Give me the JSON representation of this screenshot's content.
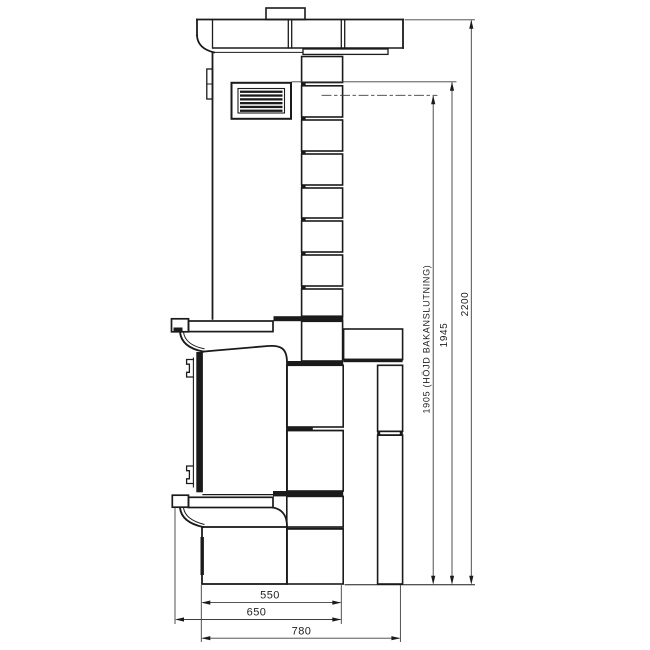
{
  "drawing": {
    "subject": "stove-side-view-technical-drawing",
    "colors": {
      "line": "#1b1b1b",
      "dimension_line": "#3d3d3d",
      "background": "#ffffff"
    }
  },
  "dimensions": {
    "vertical": [
      {
        "key": "back_connection_height",
        "label": "1905 (HÖJD BAKANSLUTNING)"
      },
      {
        "key": "mid_height",
        "label": "1945"
      },
      {
        "key": "total_height",
        "label": "2200"
      }
    ],
    "horizontal": [
      {
        "key": "bench_depth",
        "label": "550"
      },
      {
        "key": "mantel_depth",
        "label": "650"
      },
      {
        "key": "total_depth",
        "label": "780"
      }
    ]
  }
}
